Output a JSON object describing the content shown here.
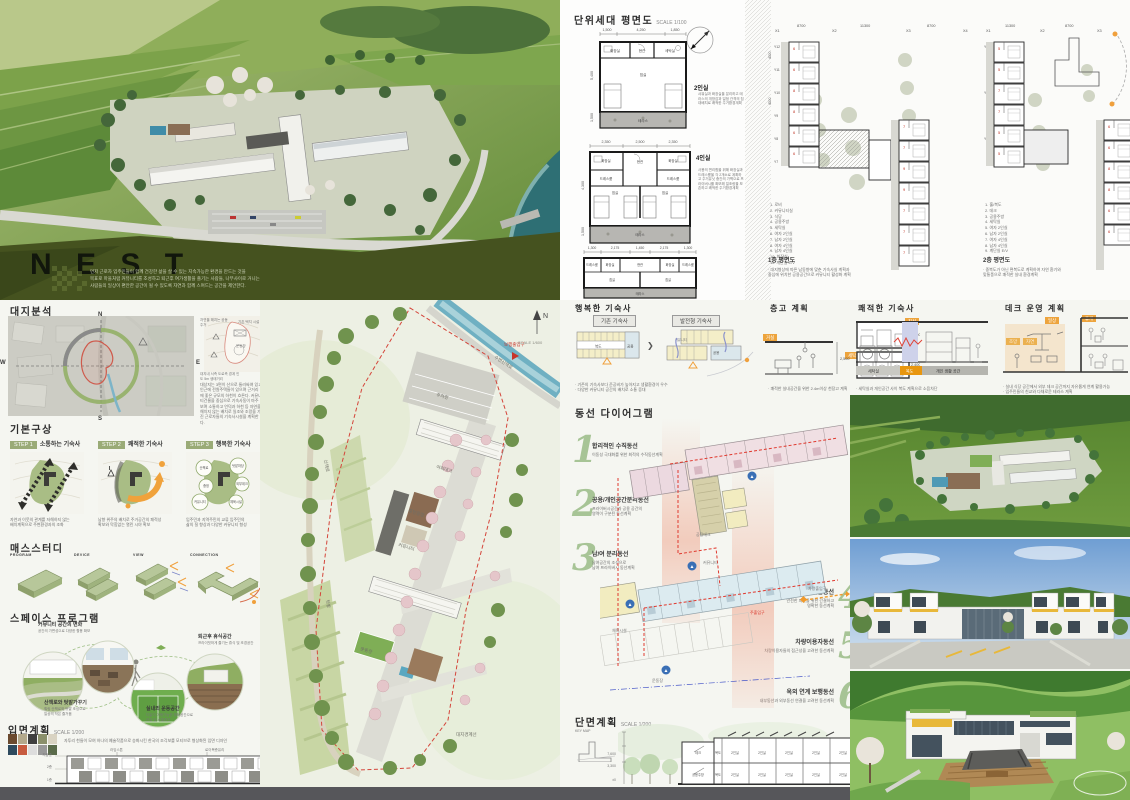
{
  "poster": {
    "title": "N E S T",
    "desc": "먼저 근로자 입주민들이 함께 건강한 삶을 살 수 있는 지속가능한 환경을 만드는 것을\n목표로 마을처럼 커뮤니티를 조성하고 퇴근후 여가생활을 즐기는 사람들, 나무사이로 거니는\n사람들의 일상이 편안한 공간이 될 수 있도록 자연과 함께 스며드는 공간을 제안한다."
  },
  "site_analysis": {
    "title": "대지분석",
    "compass": {
      "n": "N",
      "w": "W",
      "e": "E",
      "s": "S"
    },
    "context_labels": [
      "자연을 해치는 공동주거",
      "기존 택지 시설",
      "운동장",
      "대지내 서측 도로측 경계 인도 5m 생태거리"
    ],
    "paragraph": "대상지는 3면이 산으로 둘러싸여 있고 인근에 전원주택들이 있으며 근거리에 좋은 규모의 하천이 흐른다. 커뮤니티건물을 중심으로 기숙사동이 마주보며 소통하고 언덕과 하천 등 자연을 해치지 않는 배치로 일조와 조망을 가진 근로자들의 기숙사시설을 계획한다."
  },
  "concept": {
    "title": "기본구상",
    "steps": [
      {
        "badge": "STEP 1",
        "title": "소통하는 기숙사",
        "subtitle": "이웃과 지역이 소통하는 기숙사",
        "caption": "자연과 이웃의 관계를 저해하지 않는\n배치계획으로 주변환경과의 조화"
      },
      {
        "badge": "STEP 2",
        "title": "쾌적한 기숙사",
        "subtitle": "일조와 조망을 누리는 기숙사",
        "caption": "남향 위주의 배치로 주거공간의 쾌적성\n확보와 막힘없는 열린 시야 확보"
      },
      {
        "badge": "STEP 3",
        "title": "행복한 기숙사",
        "subtitle": "다양한 커뮤니티가 있는 기숙사",
        "caption": "입주민과 지역주민의 교류 입주민의\n삶의 질 향상과 다양한 커뮤니티 형성"
      }
    ],
    "step3_bubbles": [
      "산책로",
      "텃밭마당",
      "외부데크",
      "중정",
      "커뮤니티",
      "체육시설"
    ]
  },
  "mass_study": {
    "title": "매스스터디",
    "items": [
      "PROGRAM",
      "DEVICE",
      "VIEW",
      "CONNECTION"
    ]
  },
  "space_program": {
    "title": "스페이스 프로그램",
    "items": [
      {
        "label": "커뮤니티 공간의 변화",
        "desc": "공간의 가변성으로 다양한 활용 확보"
      },
      {
        "label": "퇴근후 휴식공간",
        "desc": "프라이빗하게 즐기는 휴식 및 조경공간"
      },
      {
        "label": "산책로와 텃밭가꾸기",
        "desc": "힐링 산책로와 텃밭 조성으로\n일상의 작은 즐거움"
      },
      {
        "label": "실내외 운동공간",
        "desc": "다같이 이용가능한 체육공간으로\n건강 및 소통증진"
      }
    ]
  },
  "elevation": {
    "title": "입면계획",
    "scale": "SCALE 1/200",
    "desc": "자투리 천들이 모여 하나의 예술작품으로 승화시킨 한국의 조각보를 모티브로 형상화된 입면 디자인",
    "callouts": [
      "라임스톤",
      "로이복층유리",
      "외부수성페인트",
      "외부수성페인트",
      "치장벽돌",
      "로이복층유리",
      "라임스톤"
    ],
    "levels": [
      "지붕층",
      "2층",
      "1층"
    ]
  },
  "unit_plans": {
    "title": "단위세대 평면도",
    "scale": "SCALE 1/100",
    "unit2": {
      "name": "2인실",
      "dims_top": [
        "1,500",
        "4,250",
        "1,850"
      ],
      "dim_v1": "5,400",
      "dim_v2": "1,500",
      "rooms": {
        "entry": "현관",
        "bath": "화장실",
        "laundry": "세탁실",
        "bedroom": "침실",
        "terrace": "테라스"
      },
      "desc": "샤워실과 화장실을 분리하고 테라스의 개방감과 일정 간격의 침대배치로 쾌적한 주거환경계획"
    },
    "unit4": {
      "name": "4인실",
      "dims_top": [
        "2,350",
        "2,500",
        "2,350"
      ],
      "dim_v1": "4,300",
      "dim_v2": "1,500",
      "rooms": {
        "bath1": "화장실",
        "entry": "현관",
        "bath2": "화장실",
        "dress1": "드레스룸",
        "dress2": "드레스룸",
        "bed1": "침실",
        "bed2": "침실",
        "terrace": "테라스"
      },
      "desc": "사용의 편리함을 위해 화장실과 드레스룸을 각 2개소로 계획하고 주거유닛 중간의 가벽으로 프라이버시를 확보해 일조량을 보존하고 쾌적한 주거환경계획"
    },
    "unit4b": {
      "dims_top": [
        "1,300",
        "2,175",
        "1,450",
        "2,175",
        "1,300"
      ],
      "dim_v1": "5,400",
      "dim_v2": "1,500",
      "rooms": {
        "dress1": "드레스룸",
        "bath1": "화장실",
        "entry": "현관",
        "bath2": "화장실",
        "dress2": "드레스룸",
        "bed1": "침실",
        "bed2": "침실",
        "terrace": "테라스"
      }
    }
  },
  "overall_plan": {
    "title": "전체 동평면도",
    "scale": "SCALE 1/200",
    "grid_x": [
      "X1",
      "X2",
      "X3",
      "X4"
    ],
    "dims_x": [
      "8700",
      "11300",
      "8700"
    ],
    "grid_y": [
      "Y12",
      "Y11",
      "Y10",
      "Y9",
      "Y8",
      "Y7"
    ],
    "dim_y": "4300",
    "floor1": {
      "label": "1층 평면도",
      "legend": "1. 로비\n2. 커뮤니티실\n3. 식당\n4. 공용주방\n5. 세탁실\n6. 여자 2인실\n7. 남자 2인실\n8. 여자 4인실\n9. 남자 4인실\n10. 화장실\n11. 계단실 E/V",
      "caption": "· 대지형상에 따른 남동향에 맞춘 기숙사실 계획과\n중심에 위치한 공용공간으로 커뮤니티 활성화 계획"
    },
    "floor2": {
      "label": "2층 평면도",
      "legend": "1. 홀/복도\n2. 데크\n3. 공용주방\n4. 세탁실\n5. 여자 2인실\n6. 남자 2인실\n7. 여자 4인실\n8. 남자 4인실\n9. 계단실 E/V",
      "caption": "· 중복도가 아닌 편복도로 계획하여 자연 환기와\n맞통풍으로 쾌적한 실내 환경계획"
    }
  },
  "happy": {
    "title": "행복한 기숙사",
    "left_tag": "기존 기숙사",
    "right_tag": "발전형 기숙사",
    "left_corridor": "복도",
    "left_common": "공용",
    "right_community": "커뮤니티",
    "right_common": "공용",
    "captions": "· 기존의 기숙사보다 준공비가 높아지고 생활환경이 우수\n· 다양한 커뮤니티 공간의 배치로 소통 증대"
  },
  "floor_height": {
    "title": "층고 계획",
    "tags": [
      "거실",
      "침실",
      "세탁"
    ],
    "dims": [
      "2,500",
      "2,400",
      "2,400"
    ],
    "caption": "· 쾌적한 실내공간을 위한 2.4m이상 천장고 계획"
  },
  "comfort": {
    "title": "쾌적한 기숙사",
    "labels": [
      "세탁실",
      "복도",
      "개인 생활 공간"
    ],
    "caption": "· 세탁실과 개인공간 사이 복도 계획으로 소음차단"
  },
  "deck": {
    "title": "데크 운영 계획",
    "tags": [
      "일상",
      "휴게",
      "조망",
      "자연"
    ],
    "captions": "· 실내 식당 공간에서 외부 데크 공간까지 자유롭게 연계 활용가능\n· 입주민들의 친교와 다채로운 테라스 계획"
  },
  "circulation": {
    "title": "동선 다이어그램",
    "items": [
      {
        "no": "1",
        "title": "합리적인 수직동선",
        "desc": "이동성 극대화를 위한 최적의 수직동선계획"
      },
      {
        "no": "2",
        "title": "공용/개인공간분리동선",
        "desc": "프라이버시공간과 공용 공간의\n영역이 구분된 동선계획"
      },
      {
        "no": "3",
        "title": "남/여 분리동선",
        "desc": "남여공간의 조성으로\n남여 프라이버시 동선계획"
      },
      {
        "no": "4",
        "title": "피난동선",
        "desc": "안전한 피난을 위한 간결하고\n명확한 동선계획"
      },
      {
        "no": "5",
        "title": "차량이용자동선",
        "desc": "차량이용자들의 접근성을 고려한 동선계획"
      },
      {
        "no": "6",
        "title": "옥외 연계 보행동선",
        "desc": "내부동선과 외부동선 연결을 고려한 동선계획"
      }
    ],
    "annotations": {
      "main_entry": "주출입구",
      "car_entry": "차량출입구",
      "community": "커뮤니티",
      "deck": "공용데크",
      "sports": "체육시설",
      "field": "운동장"
    }
  },
  "section_plan": {
    "title": "단면계획",
    "scale": "SCALE 1/200",
    "keymap": "KEY MAP",
    "solar": "태양광 발전시스템",
    "upper_rooms": [
      "데크",
      "복도",
      "2인실",
      "2인실",
      "2인실",
      "2인실",
      "2인실"
    ],
    "lower_rooms": [
      "공용주방",
      "복도",
      "2인실",
      "2인실",
      "2인실",
      "2인실",
      "2인실"
    ],
    "levels": [
      "7,600",
      "3,300",
      "±0"
    ]
  },
  "site_plan": {
    "north": "N",
    "scale": "SCALE 1/600",
    "labels": [
      "수변산책로",
      "주차장",
      "야외데크",
      "중앙광장",
      "커뮤니티",
      "운동장",
      "텃밭",
      "산책로",
      "보행출입구",
      "대지경계선"
    ]
  }
}
